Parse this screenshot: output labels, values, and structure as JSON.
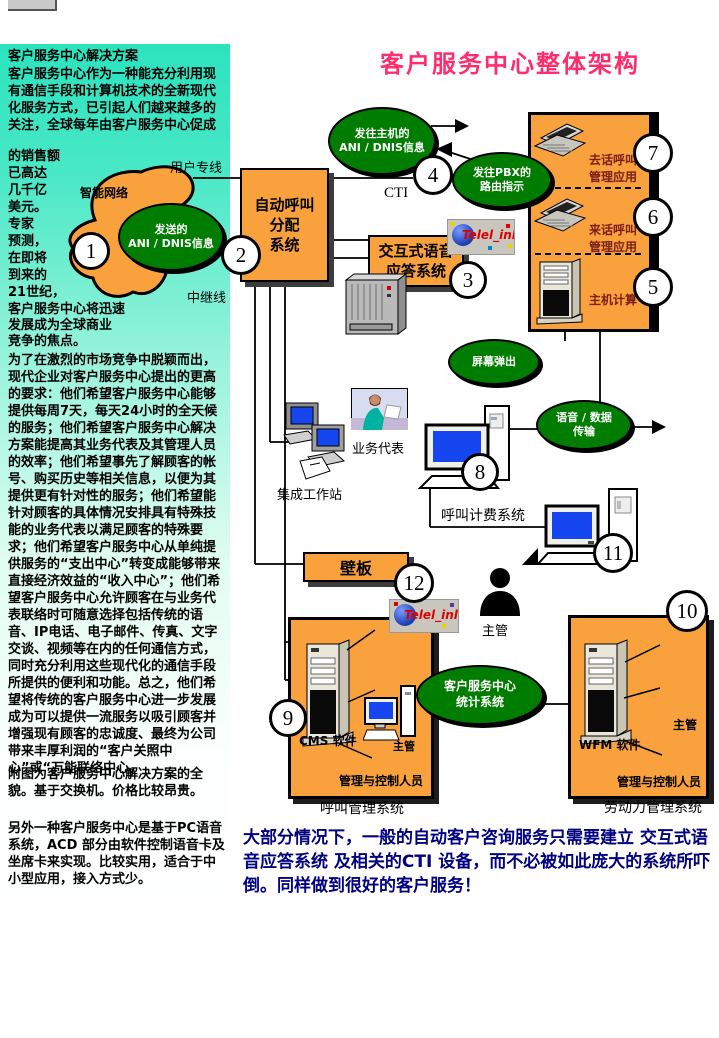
{
  "colors": {
    "orange": "#f9a13d",
    "green": "#007c00",
    "title_magenta": "#ff2d6e",
    "footer_navy": "#000080",
    "sidebar_top": "#2ce3be",
    "sidebar_bottom": "#ffffff",
    "box_label_maroon": "#7a2018"
  },
  "sidebar": {
    "title": "客户服务中心解决方案",
    "p1": "客户服务中心作为一种能充分利用现有通信手段和计算机技术的全新现代化服务方式，已引起人们越来越多的关注，全球每年由客户服务中心促成",
    "p2": "的销售额\n已高达\n几千亿\n美元。\n专家\n预测，\n在即将\n到来的\n21世纪，",
    "p3": "客户服务中心将迅速\n发展成为全球商业\n竞争的焦点。",
    "p4": "为了在激烈的市场竞争中脱颖而出，现代企业对客户服务中心提出的更高的要求：他们希望客户服务中心能够提供每周7天，每天24小时的全天候的服务；他们希望客户服务中心解决方案能提高其业务代表及其管理人员的效率；他们希望事先了解顾客的帐号、购买历史等相关信息，以便为其提供更有针对性的服务；他们希望能针对顾客的具体情况安排具有特殊技能的业务代表以满足顾客的特殊要求；他们希望客户服务中心从单纯提供服务的“支出中心”转变成能够带来直接经济效益的“收入中心”；他们希望客户服务中心允许顾客在与业务代表联络时可随意选择包括传统的语音、IP电话、电子邮件、传真、文字交谈、视频等在内的任何通信方式，同时充分利用这些现代化的通信手段所提供的便利和功能。总之，他们希望将传统的客户服务中心进一步发展成为可以提供一流服务以吸引顾客并增强现有顾客的忠诚度、最终为公司带来丰厚利润的“客户关照中心”或“万能联络中心。",
    "p5": "附图为客户服务中心解决方案的全貌。基于交换机。价格比较昂贵。",
    "p6": "另外一种客户服务中心是基于PC语音系统，ACD 部分由软件控制语音卡及坐席卡来实现。比较实用，适合于中小型应用，接入方式少。"
  },
  "diagram": {
    "title": "客户服务中心整体架构",
    "steps": [
      "1",
      "2",
      "3",
      "4",
      "5",
      "6",
      "7",
      "8",
      "9",
      "10",
      "11",
      "12"
    ],
    "ellipses": {
      "send_ani": "发送的\nANI / DNIS信息",
      "ani_to_host": "发往主机的\nANI / DNIS信息",
      "route_to_pbx": "发往PBX的\n路由指示",
      "screen_pop": "屏幕弹出",
      "voice_data": "语音 / 数据\n传输",
      "stats": "客户服务中心\n统计系统"
    },
    "boxes": {
      "acd": "自动呼叫\n分配\n系统",
      "ivr": "交互式语音\n应答系统",
      "wallboard": "壁板",
      "outbound": "去话呼叫\n管理应用",
      "inbound": "来话呼叫\n管理应用",
      "host": "主机计算",
      "cms": "CMS 软件",
      "wfm": "WFM 软件",
      "mgmt": "管理与控制人员"
    },
    "labels": {
      "user_line": "用户专线",
      "trunk_line": "中继线",
      "cti": "CTI",
      "intelligent_network": "智能网络",
      "agent": "业务代表",
      "workstation": "集成工作站",
      "billing": "呼叫计费系统",
      "supervisor": "主管",
      "call_mgmt": "呼叫管理系统",
      "workforce": "劳动力管理系统",
      "logo": "Telel_inln"
    },
    "footer": "大部分情况下，一般的自动客户咨询服务只需要建立 交互式语音应答系统 及相关的CTI 设备，而不必被如此庞大的系统所吓倒。同样做到很好的客户服务！"
  }
}
